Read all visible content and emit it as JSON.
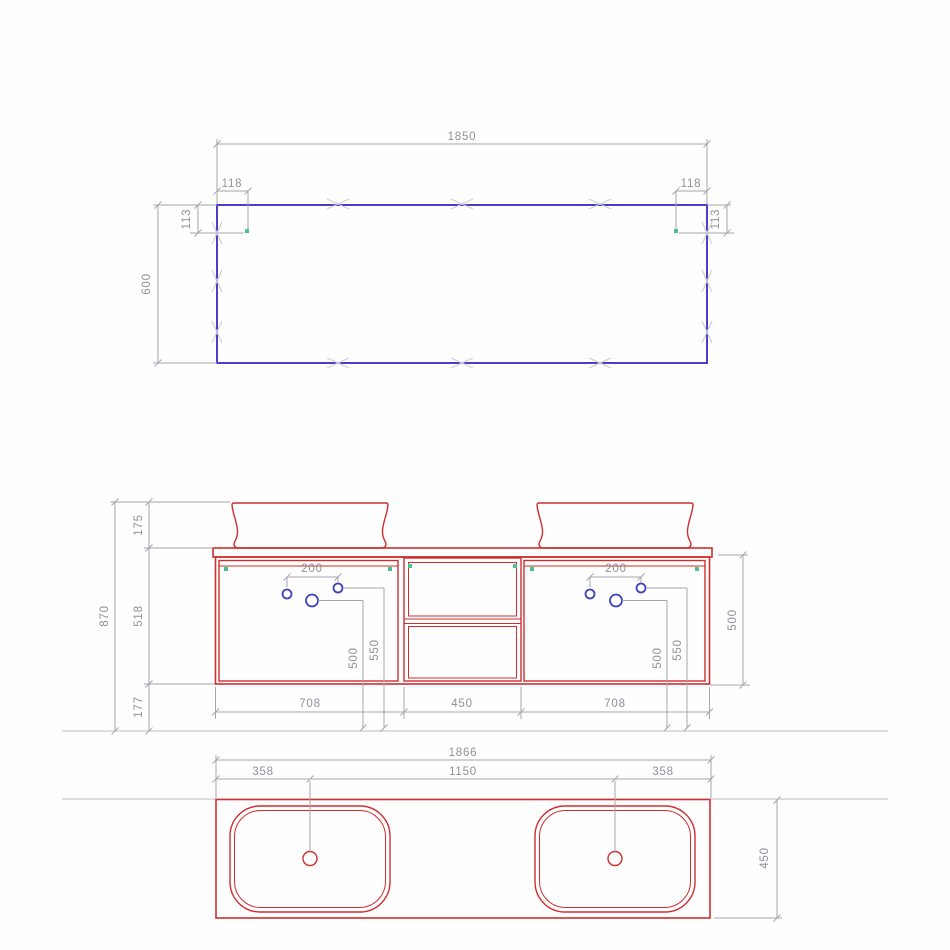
{
  "colors": {
    "panel_outline_blue": "#4b3ec9",
    "cabinet_outline_red": "#cf2e2e",
    "tap_hole_blue": "#4040c0",
    "fixing_point_green": "#46c38f",
    "dimension_gray": "#90909a"
  },
  "views": {
    "top": {
      "dims": {
        "width": "1850",
        "inset_left": "118",
        "inset_right": "118",
        "drop_left": "113",
        "drop_right": "113",
        "depth": "600"
      }
    },
    "front": {
      "dims": {
        "total_height": "870",
        "basin_height": "175",
        "cabinet_height": "518",
        "floor_clearance": "177",
        "tap_spacing_left": "200",
        "tap_spacing_right": "200",
        "tap_height_inner_left": "500",
        "tap_height_outer_left": "550",
        "tap_height_inner_right": "500",
        "tap_height_outer_right": "550",
        "door_width_left": "708",
        "shelf_width": "450",
        "door_width_right": "708",
        "carcass_height": "500"
      }
    },
    "plan": {
      "dims": {
        "width": "1866",
        "drain_offset_left": "358",
        "drain_spacing": "1150",
        "drain_offset_right": "358",
        "depth": "450"
      }
    }
  }
}
